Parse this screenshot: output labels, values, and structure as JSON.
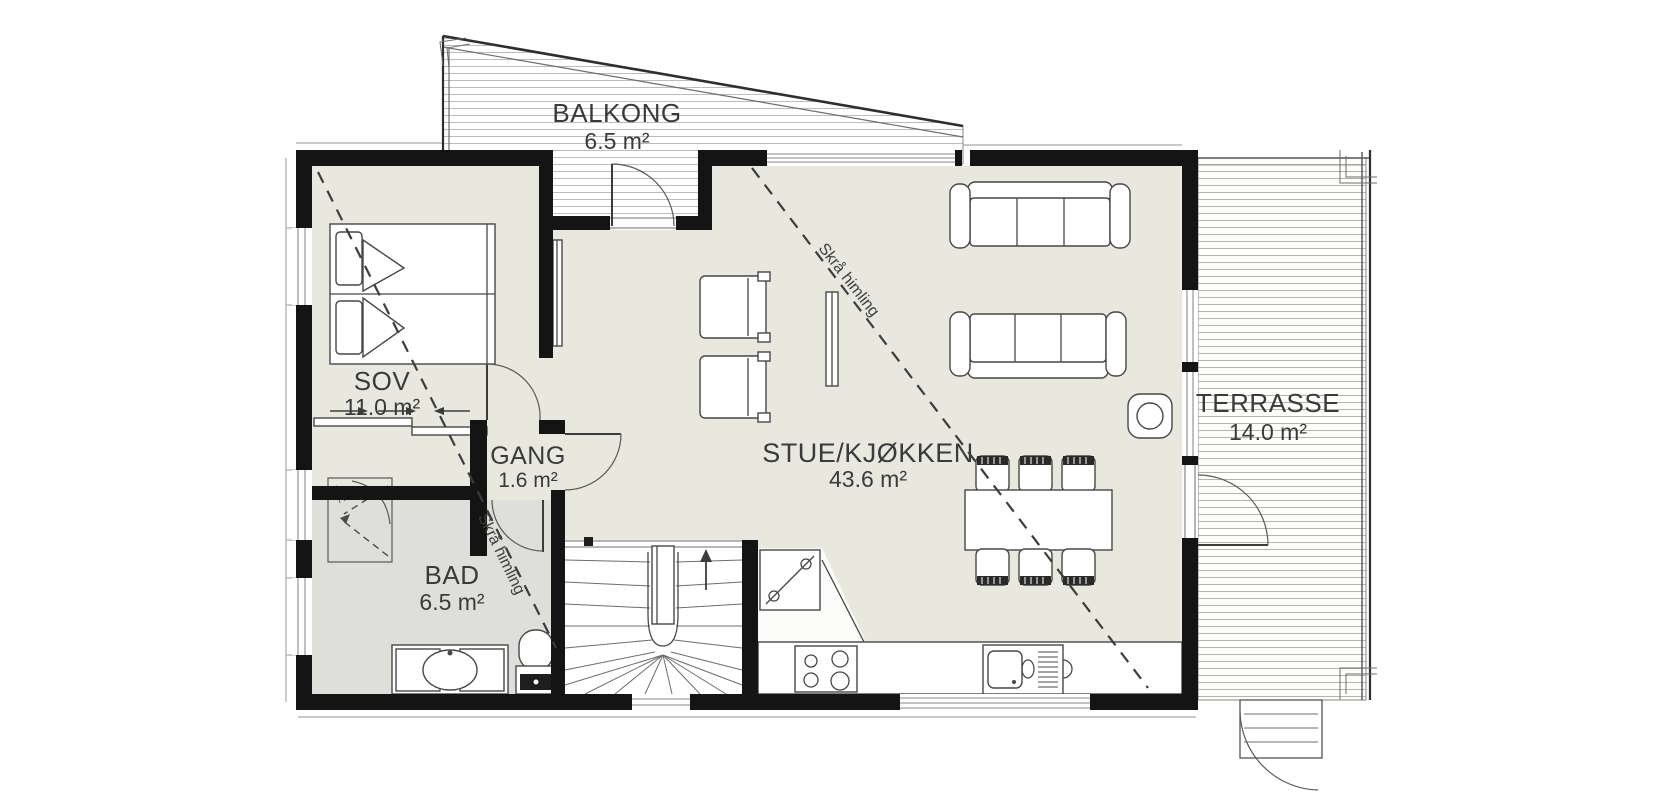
{
  "plan": {
    "title": "Apartment floor plan",
    "rooms": {
      "balkong": {
        "name": "BALKONG",
        "area": "6.5 m²"
      },
      "sov": {
        "name": "SOV",
        "area": "11.0 m²"
      },
      "gang": {
        "name": "GANG",
        "area": "1.6 m²"
      },
      "bad": {
        "name": "BAD",
        "area": "6.5 m²"
      },
      "stue_kjokken": {
        "name": "STUE/KJØKKEN",
        "area": "43.6 m²"
      },
      "terrasse": {
        "name": "TERRASSE",
        "area": "14.0 m²"
      }
    },
    "annotations": {
      "sloped_ceiling_1": "Skrå himling",
      "sloped_ceiling_2": "Skrå himling"
    },
    "symbols": [
      "double-bed",
      "sliding-wardrobe-doors",
      "shower",
      "vanity-sink",
      "toilet",
      "winder-staircase",
      "stair-up-arrow",
      "appliance-cabinet",
      "cooktop",
      "kitchen-sink",
      "dining-table",
      "dining-chair",
      "sofa",
      "armchair",
      "wood-stove",
      "tv-panel",
      "door-swing",
      "window",
      "balcony-decking",
      "terrace-decking",
      "terrace-steps"
    ],
    "colors": {
      "wall": "#141414",
      "floor": "#e9e8df",
      "floor_bathroom": "#dededa",
      "furniture_line": "#474747",
      "deck_line": "#b4b4ae",
      "text": "#3a3a3a",
      "background": "#ffffff"
    }
  }
}
